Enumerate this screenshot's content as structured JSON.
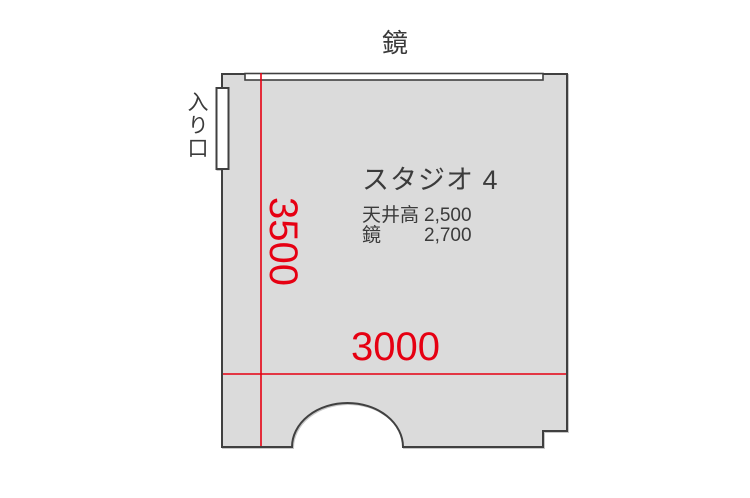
{
  "colors": {
    "floor-fill": "#dbdbdb",
    "wall-stroke": "#404040",
    "dim-red": "#e60012",
    "text-dark": "#3b3b3b"
  },
  "plan": {
    "mirror_label": "鏡",
    "entrance_label": "入り口",
    "room_title": "スタジオ 4",
    "specs": [
      {
        "label": "天井高",
        "value": "2,500"
      },
      {
        "label": "鏡",
        "value": "2,700"
      }
    ],
    "dim_vertical": "3500",
    "dim_horizontal": "3000"
  }
}
